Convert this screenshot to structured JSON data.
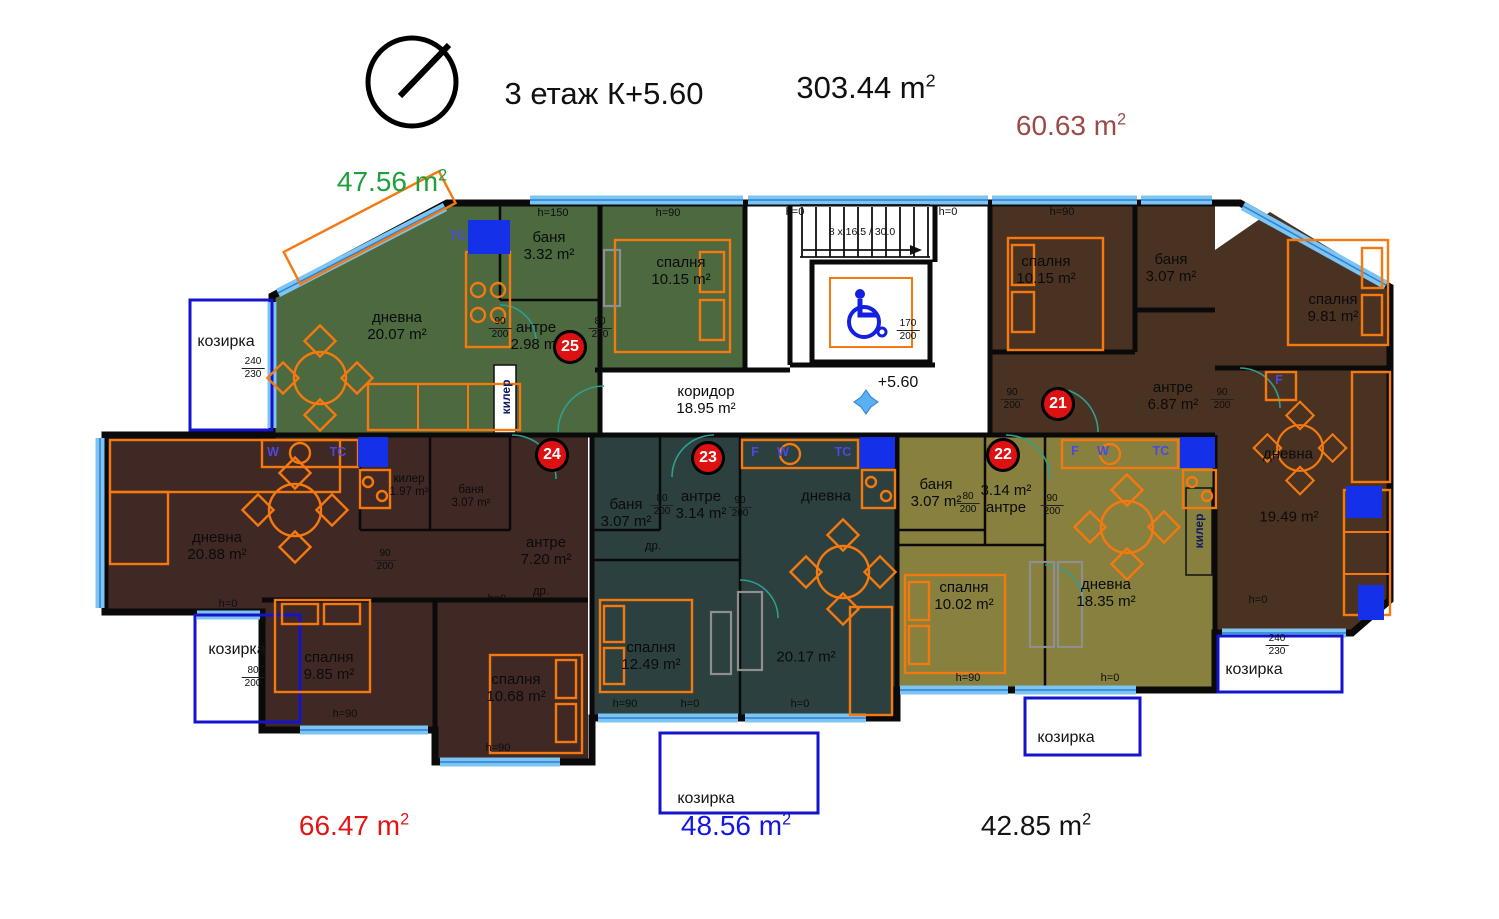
{
  "header": {
    "floor_title": "3 етаж К+5.60",
    "total_area_value": "303.44 m",
    "total_area_sup": "2"
  },
  "area_summaries": [
    {
      "id": "apt25",
      "value": "47.56 m",
      "sup": "2",
      "color": "#1fa03c"
    },
    {
      "id": "apt21",
      "value": "60.63 m",
      "sup": "2",
      "color": "#9c4a48"
    },
    {
      "id": "apt24",
      "value": "66.47 m",
      "sup": "2",
      "color": "#e41414"
    },
    {
      "id": "apt23",
      "value": "48.56 m",
      "sup": "2",
      "color": "#1414e6"
    },
    {
      "id": "apt22",
      "value": "42.85 m",
      "sup": "2",
      "color": "#141414"
    }
  ],
  "apartments": [
    {
      "number": "25",
      "color": "#4c6940",
      "rooms": [
        {
          "name": "дневна",
          "area": "20.07 m²"
        },
        {
          "name": "баня",
          "area": "3.32 m²"
        },
        {
          "name": "спалня",
          "area": "10.15 m²"
        },
        {
          "name": "антре",
          "area": "2.98 m²"
        },
        {
          "name": "килер",
          "area": ""
        }
      ]
    },
    {
      "number": "24",
      "color": "#402824",
      "rooms": [
        {
          "name": "дневна",
          "area": "20.88 m²"
        },
        {
          "name": "килер",
          "area": "1.97 m²"
        },
        {
          "name": "баня",
          "area": "3.07 m²"
        },
        {
          "name": "антре",
          "area": "7.20 m²"
        },
        {
          "name": "спалня",
          "area": "9.85 m²"
        },
        {
          "name": "спалня",
          "area": "10.68 m²"
        },
        {
          "name": "др.",
          "area": ""
        }
      ]
    },
    {
      "number": "23",
      "color": "#2b403f",
      "rooms": [
        {
          "name": "баня",
          "area": "3.07 m²"
        },
        {
          "name": "антре",
          "area": "3.14 m²"
        },
        {
          "name": "др.",
          "area": ""
        },
        {
          "name": "дневна",
          "area": "20.17 m²"
        },
        {
          "name": "спалня",
          "area": "12.49 m²"
        }
      ]
    },
    {
      "number": "22",
      "color": "#87803f",
      "rooms": [
        {
          "name": "баня",
          "area": "3.07 m²"
        },
        {
          "name": "антре",
          "area": "3.14 m²"
        },
        {
          "name": "спалня",
          "area": "10.02 m²"
        },
        {
          "name": "дневна",
          "area": "18.35 m²"
        },
        {
          "name": "килер",
          "area": ""
        }
      ]
    },
    {
      "number": "21",
      "color": "#4a3222",
      "rooms": [
        {
          "name": "спалня",
          "area": "10.15 m²"
        },
        {
          "name": "баня",
          "area": "3.07 m²"
        },
        {
          "name": "спалня",
          "area": "9.81 m²"
        },
        {
          "name": "антре",
          "area": "6.87 m²"
        },
        {
          "name": "дневна",
          "area": "19.49 m²"
        }
      ]
    }
  ],
  "common": {
    "corridor_name": "коридор",
    "corridor_area": "18.95 m²",
    "level_mark": "+5.60",
    "stairs_label": "8 x 16.5 / 30.0",
    "canopy_label": "козирка"
  },
  "colors": {
    "wall": "#0a0a0a",
    "window": "#7cc4f2",
    "window_line": "#2f7fd4",
    "furniture": "#f4790f",
    "door_arc": "#2f9f8f",
    "badge": "#dd1111",
    "canopy_border": "#1414cc",
    "appliance_blue": "#1430e8"
  },
  "annotations": [
    {
      "x": 553,
      "y": 213,
      "text": "h=150",
      "cls": "h",
      "n": "window-height-label"
    },
    {
      "x": 668,
      "y": 213,
      "text": "h=90",
      "cls": "h",
      "n": "window-height-label"
    },
    {
      "x": 795,
      "y": 212,
      "text": "h=0",
      "cls": "h",
      "n": "window-height-label"
    },
    {
      "x": 948,
      "y": 212,
      "text": "h=0",
      "cls": "h",
      "n": "window-height-label"
    },
    {
      "x": 1062,
      "y": 212,
      "text": "h=90",
      "cls": "h",
      "n": "window-height-label"
    },
    {
      "x": 228,
      "y": 604,
      "text": "h=0",
      "cls": "h",
      "n": "window-height-label"
    },
    {
      "x": 497,
      "y": 599,
      "text": "h=0",
      "cls": "h",
      "n": "window-height-label"
    },
    {
      "x": 345,
      "y": 714,
      "text": "h=90",
      "cls": "h",
      "n": "window-height-label"
    },
    {
      "x": 498,
      "y": 748,
      "text": "h=90",
      "cls": "h",
      "n": "window-height-label"
    },
    {
      "x": 625,
      "y": 704,
      "text": "h=90",
      "cls": "h",
      "n": "window-height-label"
    },
    {
      "x": 690,
      "y": 704,
      "text": "h=0",
      "cls": "h",
      "n": "window-height-label"
    },
    {
      "x": 800,
      "y": 704,
      "text": "h=0",
      "cls": "h",
      "n": "window-height-label"
    },
    {
      "x": 968,
      "y": 678,
      "text": "h=90",
      "cls": "h",
      "n": "window-height-label"
    },
    {
      "x": 1110,
      "y": 678,
      "text": "h=0",
      "cls": "h",
      "n": "window-height-label"
    },
    {
      "x": 1258,
      "y": 600,
      "text": "h=0",
      "cls": "h",
      "n": "window-height-label"
    },
    {
      "x": 500,
      "y": 328,
      "text": "90/200",
      "cls": "dim",
      "n": "door-size-label"
    },
    {
      "x": 600,
      "y": 328,
      "text": "80/200",
      "cls": "dim",
      "n": "door-size-label"
    },
    {
      "x": 253,
      "y": 368,
      "text": "240/230",
      "cls": "dim",
      "n": "opening-size-label"
    },
    {
      "x": 253,
      "y": 677,
      "text": "80/200",
      "cls": "dim",
      "n": "door-size-label"
    },
    {
      "x": 908,
      "y": 330,
      "text": "170/200",
      "cls": "dim",
      "n": "opening-size-label"
    },
    {
      "x": 1012,
      "y": 399,
      "text": "90/200",
      "cls": "dim",
      "n": "door-size-label"
    },
    {
      "x": 1222,
      "y": 399,
      "text": "90/200",
      "cls": "dim",
      "n": "door-size-label"
    },
    {
      "x": 968,
      "y": 503,
      "text": "80/200",
      "cls": "dim",
      "n": "door-size-label"
    },
    {
      "x": 1052,
      "y": 505,
      "text": "90/200",
      "cls": "dim",
      "n": "door-size-label"
    },
    {
      "x": 662,
      "y": 505,
      "text": "80/200",
      "cls": "dim",
      "n": "door-size-label"
    },
    {
      "x": 740,
      "y": 507,
      "text": "90/200",
      "cls": "dim",
      "n": "door-size-label"
    },
    {
      "x": 385,
      "y": 560,
      "text": "90/200",
      "cls": "dim",
      "n": "door-size-label"
    },
    {
      "x": 1277,
      "y": 645,
      "text": "240/230",
      "cls": "dim",
      "n": "opening-size-label"
    },
    {
      "x": 458,
      "y": 236,
      "text": "ТС",
      "cls": "app",
      "n": "appliance-label"
    },
    {
      "x": 273,
      "y": 452,
      "text": "W",
      "cls": "app",
      "n": "appliance-label"
    },
    {
      "x": 338,
      "y": 452,
      "text": "ТС",
      "cls": "app",
      "n": "appliance-label"
    },
    {
      "x": 755,
      "y": 452,
      "text": "F",
      "cls": "app",
      "n": "appliance-label"
    },
    {
      "x": 783,
      "y": 452,
      "text": "W",
      "cls": "app",
      "n": "appliance-label"
    },
    {
      "x": 843,
      "y": 452,
      "text": "ТС",
      "cls": "app",
      "n": "appliance-label"
    },
    {
      "x": 1075,
      "y": 451,
      "text": "F",
      "cls": "app",
      "n": "appliance-label"
    },
    {
      "x": 1103,
      "y": 451,
      "text": "W",
      "cls": "app",
      "n": "appliance-label"
    },
    {
      "x": 1161,
      "y": 451,
      "text": "ТС",
      "cls": "app",
      "n": "appliance-label"
    },
    {
      "x": 1279,
      "y": 380,
      "text": "F",
      "cls": "app",
      "n": "appliance-label"
    }
  ]
}
